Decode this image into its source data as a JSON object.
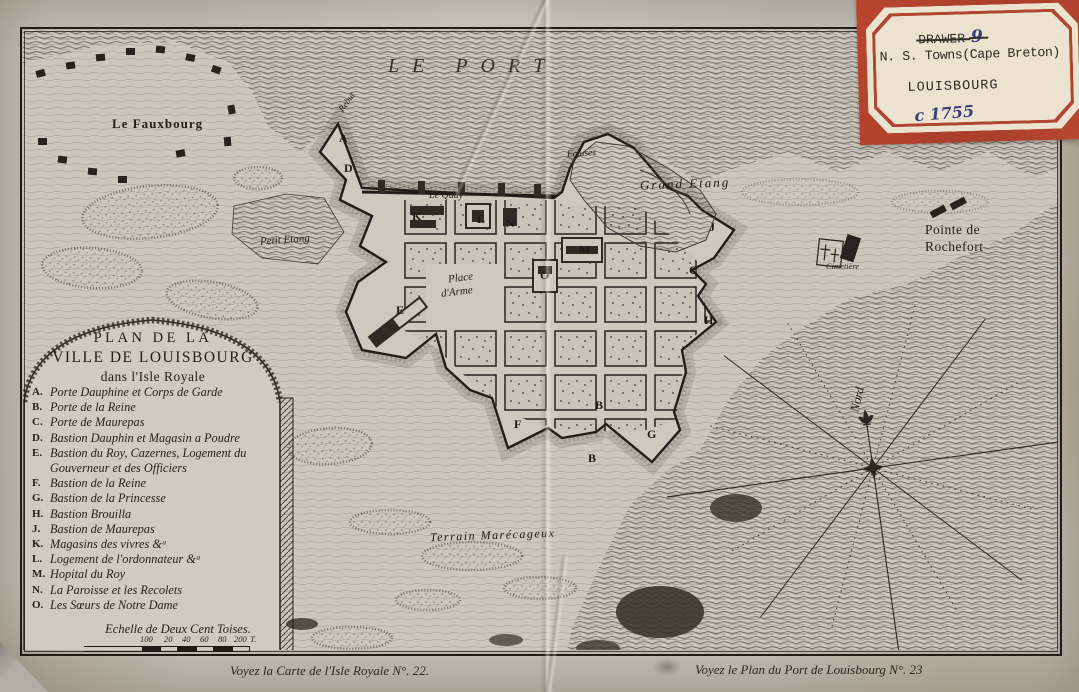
{
  "archival_label": {
    "drawer_struck": "DRAWER",
    "drawer_number": "9",
    "region_line": "N. S. Towns(Cape Breton)",
    "town_line": "LOUISBOURG",
    "date_line": "c 1755"
  },
  "map_labels": {
    "port": "LE PORT",
    "fauxbourg": "Le Fauxbourg",
    "petit_etang": "Petit Etang",
    "le_quay": "Le Quay",
    "place_line1": "Place",
    "place_line2": "d'Arme",
    "ecluses": "Ecluses",
    "grand_etang": "Grand Etang",
    "rochefort_line1": "Pointe de",
    "rochefort_line2": "Rochefort",
    "cimetiere": "Cimetière",
    "terrain": "Terrain Marécageux",
    "nord": "Nord",
    "rebut": "Rebut"
  },
  "plan_markers": [
    "A",
    "D",
    "K",
    "L",
    "N",
    "M",
    "O",
    "C",
    "J",
    "H",
    "E",
    "F",
    "B",
    "G",
    "B"
  ],
  "legend": {
    "title_lines": [
      "PLAN DE LA",
      "VILLE DE LOUISBOURG",
      "dans l'Isle Royale"
    ],
    "items": [
      {
        "key": "A.",
        "text": "Porte Dauphine et Corps de Garde"
      },
      {
        "key": "B.",
        "text": "Porte de la Reine"
      },
      {
        "key": "C.",
        "text": "Porte de Maurepas"
      },
      {
        "key": "D.",
        "text": "Bastion Dauphin et Magasin a Poudre"
      },
      {
        "key": "E.",
        "text": "Bastion du Roy, Cazernes, Logement du Gouverneur et des Officiers"
      },
      {
        "key": "F.",
        "text": "Bastion de la Reine"
      },
      {
        "key": "G.",
        "text": "Bastion de la Princesse"
      },
      {
        "key": "H.",
        "text": "Bastion Brouilla"
      },
      {
        "key": "J.",
        "text": "Bastion de Maurepas"
      },
      {
        "key": "K.",
        "text": "Magasins des vivres &ᵃ"
      },
      {
        "key": "L.",
        "text": "Logement de l'ordonnateur &ᵃ"
      },
      {
        "key": "M.",
        "text": "Hopital du Roy"
      },
      {
        "key": "N.",
        "text": "La Paroisse et les Recolets"
      },
      {
        "key": "O.",
        "text": "Les Sœurs de Notre Dame"
      }
    ],
    "scale_title": "Echelle de Deux Cent Toises.",
    "scale_ticks": [
      "100",
      "20",
      "40",
      "60",
      "80",
      "200",
      "T."
    ]
  },
  "footer": {
    "left": "Voyez la Carte de l'Isle Royale N°. 22.",
    "right": "Voyez le Plan du Port de Louisbourg N°. 23"
  },
  "colors": {
    "paper": "#c9c5ba",
    "ink": "#26231d",
    "label_red": "#b4432e",
    "label_cream": "#ebe3d0",
    "ink_blue": "#3b3f77"
  }
}
